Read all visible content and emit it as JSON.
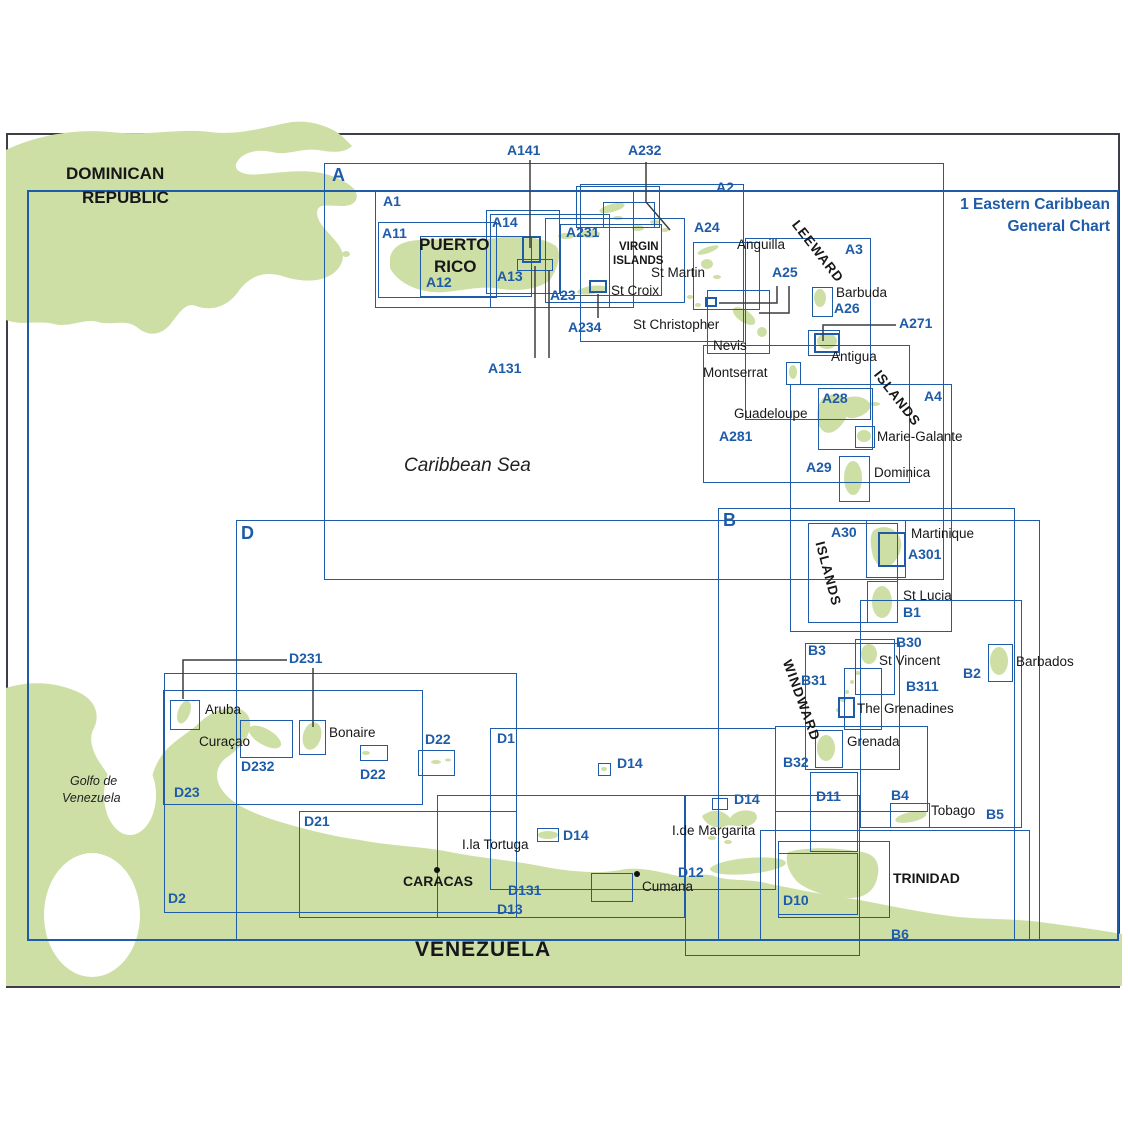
{
  "title": {
    "line1": "1 Eastern Caribbean",
    "line2": "General Chart"
  },
  "colors": {
    "chart_blue": "#1e5ba8",
    "land_green": "#cddfa4",
    "leader_grey": "#3d3d40",
    "ink": "#17171a"
  },
  "boxes": [
    {
      "id": "frame-1",
      "x": 27,
      "y": 190,
      "w": 1092,
      "h": 751,
      "wt": "w2"
    },
    {
      "id": "frame-A",
      "x": 324,
      "y": 163,
      "w": 620,
      "h": 417
    },
    {
      "id": "frame-B",
      "x": 718,
      "y": 508,
      "w": 297,
      "h": 433
    },
    {
      "id": "frame-D",
      "x": 236,
      "y": 520,
      "w": 804,
      "h": 421
    },
    {
      "id": "box-A1",
      "x": 375,
      "y": 190,
      "w": 259,
      "h": 118
    },
    {
      "id": "box-A11",
      "x": 378,
      "y": 222,
      "w": 119,
      "h": 76
    },
    {
      "id": "box-A12",
      "x": 420,
      "y": 236,
      "w": 112,
      "h": 61
    },
    {
      "id": "box-A13",
      "x": 490,
      "y": 214,
      "w": 120,
      "h": 94
    },
    {
      "id": "box-A14",
      "x": 486,
      "y": 210,
      "w": 74,
      "h": 84
    },
    {
      "id": "box-A141",
      "x": 522,
      "y": 236,
      "w": 19,
      "h": 27,
      "wt": "w3"
    },
    {
      "id": "box-A141b",
      "x": 517,
      "y": 259,
      "w": 36,
      "h": 12
    },
    {
      "id": "box-A23",
      "x": 545,
      "y": 218,
      "w": 140,
      "h": 85
    },
    {
      "id": "box-A231",
      "x": 560,
      "y": 224,
      "w": 102,
      "h": 72
    },
    {
      "id": "box-A232",
      "x": 576,
      "y": 186,
      "w": 84,
      "h": 42
    },
    {
      "id": "box-A232b",
      "x": 603,
      "y": 202,
      "w": 52,
      "h": 26
    },
    {
      "id": "box-A2",
      "x": 580,
      "y": 184,
      "w": 164,
      "h": 158
    },
    {
      "id": "box-StCroix",
      "x": 589,
      "y": 280,
      "w": 18,
      "h": 13,
      "wt": "w2"
    },
    {
      "id": "box-A24",
      "x": 693,
      "y": 242,
      "w": 67,
      "h": 68
    },
    {
      "id": "box-A25",
      "x": 707,
      "y": 290,
      "w": 63,
      "h": 64
    },
    {
      "id": "box-A25m",
      "x": 705,
      "y": 297,
      "w": 12,
      "h": 10,
      "wt": "w2"
    },
    {
      "id": "box-A26",
      "x": 812,
      "y": 287,
      "w": 21,
      "h": 30
    },
    {
      "id": "box-Antigua-outer",
      "x": 808,
      "y": 330,
      "w": 32,
      "h": 26
    },
    {
      "id": "box-Antigua-inner",
      "x": 814,
      "y": 333,
      "w": 26,
      "h": 20,
      "wt": "w3"
    },
    {
      "id": "box-Montserrat",
      "x": 786,
      "y": 362,
      "w": 15,
      "h": 23
    },
    {
      "id": "box-A3",
      "x": 745,
      "y": 238,
      "w": 126,
      "h": 182
    },
    {
      "id": "box-A28",
      "x": 818,
      "y": 388,
      "w": 55,
      "h": 62
    },
    {
      "id": "box-MarieGalante",
      "x": 855,
      "y": 426,
      "w": 20,
      "h": 22
    },
    {
      "id": "box-A281",
      "x": 703,
      "y": 345,
      "w": 207,
      "h": 138
    },
    {
      "id": "box-A29",
      "x": 839,
      "y": 456,
      "w": 31,
      "h": 46
    },
    {
      "id": "box-A4",
      "x": 790,
      "y": 384,
      "w": 162,
      "h": 248
    },
    {
      "id": "box-A30",
      "x": 808,
      "y": 523,
      "w": 90,
      "h": 100
    },
    {
      "id": "box-Martinique",
      "x": 866,
      "y": 520,
      "w": 40,
      "h": 58
    },
    {
      "id": "box-A301",
      "x": 878,
      "y": 532,
      "w": 28,
      "h": 35,
      "wt": "w3"
    },
    {
      "id": "box-B1",
      "x": 867,
      "y": 581,
      "w": 31,
      "h": 42
    },
    {
      "id": "box-B3",
      "x": 805,
      "y": 643,
      "w": 95,
      "h": 127
    },
    {
      "id": "box-B30",
      "x": 855,
      "y": 639,
      "w": 40,
      "h": 56
    },
    {
      "id": "box-B31",
      "x": 844,
      "y": 668,
      "w": 38,
      "h": 62
    },
    {
      "id": "box-B311",
      "x": 838,
      "y": 697,
      "w": 17,
      "h": 21,
      "wt": "w3"
    },
    {
      "id": "box-B32",
      "x": 775,
      "y": 726,
      "w": 153,
      "h": 86
    },
    {
      "id": "box-Grenada",
      "x": 815,
      "y": 730,
      "w": 28,
      "h": 38
    },
    {
      "id": "box-B2",
      "x": 988,
      "y": 644,
      "w": 25,
      "h": 38
    },
    {
      "id": "box-B4",
      "x": 890,
      "y": 803,
      "w": 40,
      "h": 25
    },
    {
      "id": "box-B5",
      "x": 860,
      "y": 600,
      "w": 162,
      "h": 228
    },
    {
      "id": "box-B6",
      "x": 760,
      "y": 830,
      "w": 270,
      "h": 110
    },
    {
      "id": "box-Trinidad",
      "x": 778,
      "y": 841,
      "w": 112,
      "h": 77
    },
    {
      "id": "box-D1",
      "x": 490,
      "y": 728,
      "w": 286,
      "h": 162
    },
    {
      "id": "box-D2",
      "x": 164,
      "y": 673,
      "w": 353,
      "h": 240
    },
    {
      "id": "box-D23",
      "x": 163,
      "y": 690,
      "w": 260,
      "h": 115
    },
    {
      "id": "box-D232",
      "x": 240,
      "y": 720,
      "w": 53,
      "h": 38
    },
    {
      "id": "box-Aruba",
      "x": 170,
      "y": 700,
      "w": 30,
      "h": 30
    },
    {
      "id": "box-Bonaire",
      "x": 299,
      "y": 720,
      "w": 27,
      "h": 35
    },
    {
      "id": "box-D22a",
      "x": 360,
      "y": 745,
      "w": 28,
      "h": 16
    },
    {
      "id": "box-D22b",
      "x": 418,
      "y": 750,
      "w": 37,
      "h": 26
    },
    {
      "id": "box-D21",
      "x": 299,
      "y": 811,
      "w": 218,
      "h": 107
    },
    {
      "id": "box-D13",
      "x": 437,
      "y": 795,
      "w": 248,
      "h": 123
    },
    {
      "id": "box-D131",
      "x": 591,
      "y": 873,
      "w": 42,
      "h": 29
    },
    {
      "id": "box-D14a",
      "x": 598,
      "y": 763,
      "w": 13,
      "h": 13
    },
    {
      "id": "box-D14b",
      "x": 712,
      "y": 798,
      "w": 16,
      "h": 12
    },
    {
      "id": "box-D14c",
      "x": 537,
      "y": 828,
      "w": 22,
      "h": 14
    },
    {
      "id": "box-D12",
      "x": 685,
      "y": 795,
      "w": 175,
      "h": 161
    },
    {
      "id": "box-D10",
      "x": 778,
      "y": 853,
      "w": 80,
      "h": 62
    },
    {
      "id": "box-D11",
      "x": 810,
      "y": 772,
      "w": 48,
      "h": 80
    }
  ],
  "labels": [
    {
      "id": "lbl-A",
      "text": "A",
      "x": 332,
      "y": 166,
      "cls": "big"
    },
    {
      "id": "lbl-B",
      "text": "B",
      "x": 723,
      "y": 511,
      "cls": "big"
    },
    {
      "id": "lbl-D",
      "text": "D",
      "x": 241,
      "y": 524,
      "cls": "big"
    },
    {
      "id": "lbl-A1",
      "text": "A1",
      "x": 383,
      "y": 194
    },
    {
      "id": "lbl-A11",
      "text": "A11",
      "x": 382,
      "y": 226
    },
    {
      "id": "lbl-A12",
      "text": "A12",
      "x": 426,
      "y": 275
    },
    {
      "id": "lbl-A13",
      "text": "A13",
      "x": 497,
      "y": 269
    },
    {
      "id": "lbl-A14",
      "text": "A14",
      "x": 492,
      "y": 215
    },
    {
      "id": "lbl-A141",
      "text": "A141",
      "x": 507,
      "y": 143
    },
    {
      "id": "lbl-A232",
      "text": "A232",
      "x": 628,
      "y": 143
    },
    {
      "id": "lbl-A231",
      "text": "A231",
      "x": 566,
      "y": 225
    },
    {
      "id": "lbl-A23",
      "text": "A23",
      "x": 550,
      "y": 288
    },
    {
      "id": "lbl-A234",
      "text": "A234",
      "x": 568,
      "y": 320
    },
    {
      "id": "lbl-A131",
      "text": "A131",
      "x": 488,
      "y": 361
    },
    {
      "id": "lbl-A2",
      "text": "A2",
      "x": 716,
      "y": 180
    },
    {
      "id": "lbl-A24",
      "text": "A24",
      "x": 694,
      "y": 220
    },
    {
      "id": "lbl-A25",
      "text": "A25",
      "x": 772,
      "y": 265
    },
    {
      "id": "lbl-A3",
      "text": "A3",
      "x": 845,
      "y": 242
    },
    {
      "id": "lbl-A26",
      "text": "A26",
      "x": 834,
      "y": 301
    },
    {
      "id": "lbl-A271",
      "text": "A271",
      "x": 899,
      "y": 316
    },
    {
      "id": "lbl-A28",
      "text": "A28",
      "x": 822,
      "y": 391
    },
    {
      "id": "lbl-A281",
      "text": "A281",
      "x": 719,
      "y": 429
    },
    {
      "id": "lbl-A29",
      "text": "A29",
      "x": 806,
      "y": 460
    },
    {
      "id": "lbl-A4",
      "text": "A4",
      "x": 924,
      "y": 389
    },
    {
      "id": "lbl-A30",
      "text": "A30",
      "x": 831,
      "y": 525
    },
    {
      "id": "lbl-A301",
      "text": "A301",
      "x": 908,
      "y": 547
    },
    {
      "id": "lbl-B1",
      "text": "B1",
      "x": 903,
      "y": 605
    },
    {
      "id": "lbl-B3",
      "text": "B3",
      "x": 808,
      "y": 643
    },
    {
      "id": "lbl-B30",
      "text": "B30",
      "x": 896,
      "y": 635
    },
    {
      "id": "lbl-B31",
      "text": "B31",
      "x": 801,
      "y": 673
    },
    {
      "id": "lbl-B311",
      "text": "B311",
      "x": 906,
      "y": 679
    },
    {
      "id": "lbl-B32",
      "text": "B32",
      "x": 783,
      "y": 755
    },
    {
      "id": "lbl-B2",
      "text": "B2",
      "x": 963,
      "y": 666
    },
    {
      "id": "lbl-B4",
      "text": "B4",
      "x": 891,
      "y": 788
    },
    {
      "id": "lbl-B5",
      "text": "B5",
      "x": 986,
      "y": 807
    },
    {
      "id": "lbl-B6",
      "text": "B6",
      "x": 891,
      "y": 927
    },
    {
      "id": "lbl-D1",
      "text": "D1",
      "x": 497,
      "y": 731
    },
    {
      "id": "lbl-D2",
      "text": "D2",
      "x": 168,
      "y": 891
    },
    {
      "id": "lbl-D21",
      "text": "D21",
      "x": 304,
      "y": 814
    },
    {
      "id": "lbl-D22a",
      "text": "D22",
      "x": 360,
      "y": 767
    },
    {
      "id": "lbl-D22b",
      "text": "D22",
      "x": 425,
      "y": 732
    },
    {
      "id": "lbl-D23",
      "text": "D23",
      "x": 174,
      "y": 785
    },
    {
      "id": "lbl-D231",
      "text": "D231",
      "x": 289,
      "y": 651
    },
    {
      "id": "lbl-D232",
      "text": "D232",
      "x": 241,
      "y": 759
    },
    {
      "id": "lbl-D13",
      "text": "D13",
      "x": 497,
      "y": 902
    },
    {
      "id": "lbl-D131",
      "text": "D131",
      "x": 508,
      "y": 883
    },
    {
      "id": "lbl-D14a",
      "text": "D14",
      "x": 617,
      "y": 756
    },
    {
      "id": "lbl-D14b",
      "text": "D14",
      "x": 734,
      "y": 792
    },
    {
      "id": "lbl-D14c",
      "text": "D14",
      "x": 563,
      "y": 828
    },
    {
      "id": "lbl-D12",
      "text": "D12",
      "x": 678,
      "y": 865
    },
    {
      "id": "lbl-D10",
      "text": "D10",
      "x": 783,
      "y": 893
    },
    {
      "id": "lbl-D11",
      "text": "D11",
      "x": 816,
      "y": 789
    },
    {
      "id": "lbl-dominican",
      "text": "DOMINICAN",
      "x": 66,
      "y": 165,
      "cls": "cty"
    },
    {
      "id": "lbl-republic",
      "text": "REPUBLIC",
      "x": 82,
      "y": 189,
      "cls": "cty"
    },
    {
      "id": "lbl-puerto",
      "text": "PUERTO",
      "x": 419,
      "y": 236,
      "cls": "cty"
    },
    {
      "id": "lbl-rico",
      "text": "RICO",
      "x": 434,
      "y": 258,
      "cls": "cty"
    },
    {
      "id": "lbl-virgin",
      "text": "VIRGIN",
      "x": 619,
      "y": 241,
      "cls": "visl"
    },
    {
      "id": "lbl-islands-vi",
      "text": "ISLANDS",
      "x": 613,
      "y": 255,
      "cls": "visl"
    },
    {
      "id": "lbl-anguilla",
      "text": "Anguilla",
      "x": 737,
      "y": 238,
      "cls": "blk"
    },
    {
      "id": "lbl-stmartin",
      "text": "St Martin",
      "x": 651,
      "y": 266,
      "cls": "blk"
    },
    {
      "id": "lbl-stcroix",
      "text": "St Croix",
      "x": 611,
      "y": 284,
      "cls": "blk"
    },
    {
      "id": "lbl-stchristopher",
      "text": "St Christopher",
      "x": 633,
      "y": 318,
      "cls": "blk"
    },
    {
      "id": "lbl-nevis",
      "text": "Nevis",
      "x": 713,
      "y": 339,
      "cls": "blk"
    },
    {
      "id": "lbl-barbuda",
      "text": "Barbuda",
      "x": 836,
      "y": 286,
      "cls": "blk"
    },
    {
      "id": "lbl-antigua",
      "text": "Antigua",
      "x": 831,
      "y": 350,
      "cls": "blk"
    },
    {
      "id": "lbl-montserrat",
      "text": "Montserrat",
      "x": 703,
      "y": 366,
      "cls": "blk"
    },
    {
      "id": "lbl-guadeloupe",
      "text": "Guadeloupe",
      "x": 734,
      "y": 407,
      "cls": "blk"
    },
    {
      "id": "lbl-mariegalante",
      "text": "Marie-Galante",
      "x": 877,
      "y": 430,
      "cls": "blk"
    },
    {
      "id": "lbl-dominica",
      "text": "Dominica",
      "x": 874,
      "y": 466,
      "cls": "blk"
    },
    {
      "id": "lbl-martinique",
      "text": "Martinique",
      "x": 911,
      "y": 527,
      "cls": "blk"
    },
    {
      "id": "lbl-stlucia",
      "text": "St Lucia",
      "x": 903,
      "y": 589,
      "cls": "blk"
    },
    {
      "id": "lbl-stvincent",
      "text": "St Vincent",
      "x": 879,
      "y": 654,
      "cls": "blk"
    },
    {
      "id": "lbl-grenadines",
      "text": "The Grenadines",
      "x": 857,
      "y": 702,
      "cls": "blk"
    },
    {
      "id": "lbl-grenada",
      "text": "Grenada",
      "x": 847,
      "y": 735,
      "cls": "blk"
    },
    {
      "id": "lbl-barbados",
      "text": "Barbados",
      "x": 1016,
      "y": 655,
      "cls": "blk"
    },
    {
      "id": "lbl-tobago",
      "text": "Tobago",
      "x": 931,
      "y": 804,
      "cls": "blk"
    },
    {
      "id": "lbl-trinidad",
      "text": "TRINIDAD",
      "x": 893,
      "y": 871,
      "cls": "blkb"
    },
    {
      "id": "lbl-margarita",
      "text": "I.de Margarita",
      "x": 672,
      "y": 824,
      "cls": "blk"
    },
    {
      "id": "lbl-tortuga",
      "text": "I.la Tortuga",
      "x": 462,
      "y": 838,
      "cls": "blk"
    },
    {
      "id": "lbl-caracas",
      "text": "CARACAS",
      "x": 403,
      "y": 874,
      "cls": "blkb"
    },
    {
      "id": "lbl-cumana",
      "text": "Cumana",
      "x": 642,
      "y": 880,
      "cls": "blk"
    },
    {
      "id": "lbl-aruba",
      "text": "Aruba",
      "x": 205,
      "y": 703,
      "cls": "blk"
    },
    {
      "id": "lbl-curacao",
      "text": "Curaçao",
      "x": 199,
      "y": 735,
      "cls": "blk"
    },
    {
      "id": "lbl-bonaire",
      "text": "Bonaire",
      "x": 329,
      "y": 726,
      "cls": "blk"
    },
    {
      "id": "lbl-caribbean-sea",
      "text": "Caribbean Sea",
      "x": 404,
      "y": 456,
      "cls": "sea"
    },
    {
      "id": "lbl-golfo-1",
      "text": "Golfo de",
      "x": 70,
      "y": 775,
      "cls": "gulf"
    },
    {
      "id": "lbl-golfo-2",
      "text": "Venezuela",
      "x": 62,
      "y": 792,
      "cls": "gulf"
    },
    {
      "id": "lbl-venezuela",
      "text": "VENEZUELA",
      "x": 415,
      "y": 939,
      "cls": "ven"
    },
    {
      "id": "lbl-leeward",
      "text": "LEEWARD",
      "x": 800,
      "y": 218,
      "cls": "rot",
      "rot": 52
    },
    {
      "id": "lbl-islands-leeward",
      "text": "ISLANDS",
      "x": 882,
      "y": 368,
      "cls": "rot",
      "rot": 52
    },
    {
      "id": "lbl-islands-windward",
      "text": "ISLANDS",
      "x": 826,
      "y": 540,
      "cls": "rot",
      "rot": 75
    },
    {
      "id": "lbl-windward",
      "text": "WINDWARD",
      "x": 793,
      "y": 658,
      "cls": "rot",
      "rot": 70
    }
  ],
  "leaders": [
    {
      "id": "leader-A141",
      "pts": "530,160 530,248"
    },
    {
      "id": "leader-A232",
      "pts": "646,162 646,202 670,230"
    },
    {
      "id": "leader-A131a",
      "pts": "535,266 535,358"
    },
    {
      "id": "leader-A131b",
      "pts": "549,270 549,358"
    },
    {
      "id": "leader-A234",
      "pts": "598,294 598,318"
    },
    {
      "id": "leader-A271",
      "pts": "896,325 823,325 823,341"
    },
    {
      "id": "leader-A25a",
      "pts": "777,286 777,303 719,303"
    },
    {
      "id": "leader-A25b",
      "pts": "789,286 789,313 759,313"
    },
    {
      "id": "leader-D231a",
      "pts": "287,660 183,660 183,699"
    },
    {
      "id": "leader-D231b",
      "pts": "313,668 313,727"
    }
  ],
  "city_dots": [
    {
      "id": "dot-caracas",
      "x": 437,
      "y": 870
    },
    {
      "id": "dot-cumana",
      "x": 637,
      "y": 874
    }
  ]
}
